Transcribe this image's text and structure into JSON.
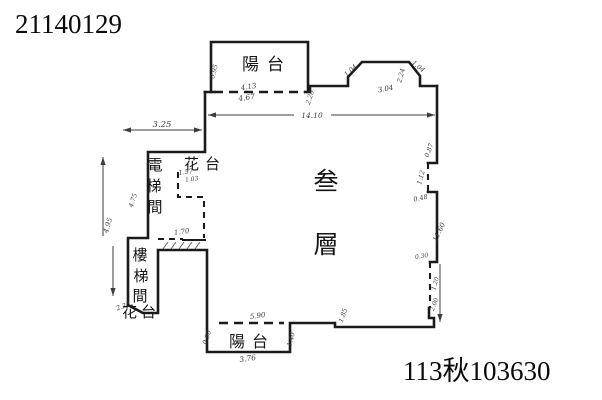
{
  "page": {
    "background": "#ffffff",
    "ink": "#1b1b1b",
    "dim_ink": "#3d3d3d"
  },
  "header": {
    "doc_number": "21140129"
  },
  "footer": {
    "case_number": "113秋103630"
  },
  "plan": {
    "labels": {
      "balcony_top": "陽台",
      "balcony_bottom": "陽台",
      "planter_top": "花台",
      "planter_bottom": "花台",
      "elevator_chars": [
        "電",
        "梯",
        "間"
      ],
      "stair_chars": [
        "樓",
        "梯",
        "間"
      ],
      "floor_chars": [
        "叁",
        "層"
      ],
      "floor_label": "叁層"
    },
    "dims": {
      "d_325": "3.25",
      "d_1410": "14.10",
      "d_413": "4.13",
      "d_467": "4.67",
      "d_095": "0.95",
      "d_220": "2.20",
      "d_104L": "1.04",
      "d_224": "2.24",
      "d_304": "3.04",
      "d_104R": "1.04",
      "d_087": "0.87",
      "d_112": "1.12",
      "d_048": "0.48",
      "d_1160": "11.60",
      "d_030": "0.30",
      "d_120": "1.20",
      "d_200": "2.00",
      "d_185": "1.85",
      "d_590": "5.90",
      "d_376": "3.76",
      "d_140": "1.40",
      "d_090": "0.90",
      "d_157": "1.57",
      "d_103": "1.03",
      "d_170": "1.70",
      "d_475": "4.75",
      "d_495": "4.95",
      "d_225": "2.25"
    }
  }
}
